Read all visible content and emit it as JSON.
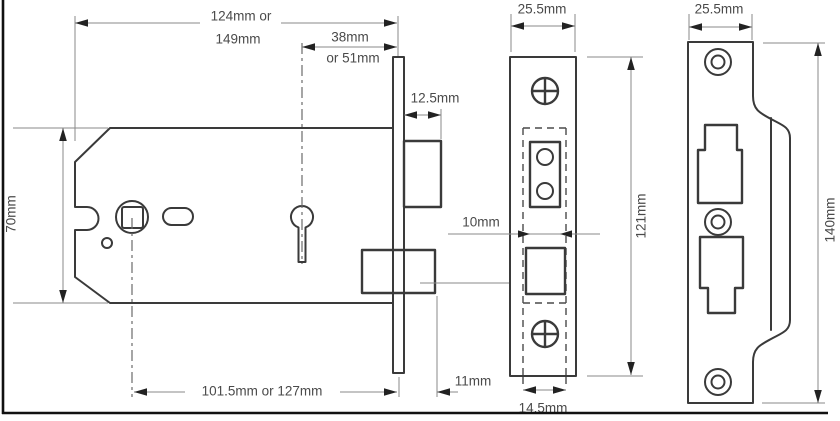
{
  "diagram_type": "mortice-lock-technical-drawing",
  "colors": {
    "background": "#ffffff",
    "outline": "#3a3a3a",
    "dimension_line": "#8a8a8a",
    "arrow": "#222222",
    "text": "#4a4a4a",
    "border": "#111111"
  },
  "side_view": {
    "dim_length_line1": "124mm or",
    "dim_length_line2": "149mm",
    "dim_backset_line1": "38mm",
    "dim_backset_line2": "or 51mm",
    "dim_latch_projection": "12.5mm",
    "dim_case_height": "70mm",
    "dim_centres": "101.5mm or 127mm",
    "dim_bolt_throw": "11mm"
  },
  "forend_view": {
    "dim_width": "25.5mm",
    "dim_latch_width": "10mm",
    "dim_height": "121mm",
    "dim_case_thickness": "14.5mm"
  },
  "strike_view": {
    "dim_width": "25.5mm",
    "dim_height": "140mm"
  }
}
